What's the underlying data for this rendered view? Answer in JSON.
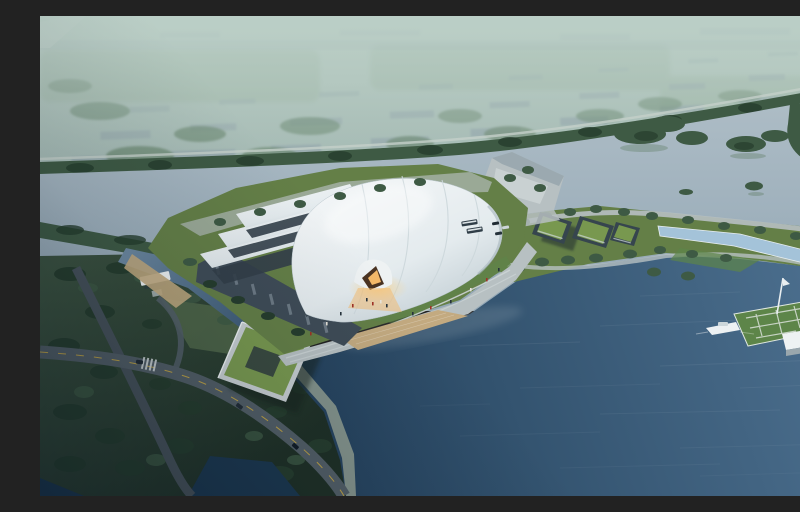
{
  "scene": {
    "kind": "aerial-architectural-rendering",
    "subject": "lakeside exhibition hall with layered white shell roof",
    "time_of_day": "hazy dusk",
    "elements": [
      "hazy distant cityscape with low gray blocks and tree masses",
      "tree-lined shore road separating city from lake",
      "pale upper lake with wooded islands",
      "white curved-shell exhibition hall with dark striped base",
      "amber-lit entrance arch with visitors",
      "waterfront promenade with steps and timber deck",
      "angular jetty plaza",
      "green-roof office buildings with parking, buses and cars",
      "linear reflecting pool in waterfront park strip",
      "lawn pier with mast, white pavilion and motor boat",
      "L-shaped green-roof courtyard building",
      "road bridge over dark channel",
      "deep blue bay in the foreground"
    ]
  },
  "palette": {
    "haze_top": "#b4c7bd",
    "haze_mid": "#9cb1ad",
    "city_block": "#8b9da6",
    "field": "#8fa892",
    "tree_far": "#5c7a5f",
    "tree_mid": "#3e5a44",
    "tree_dark": "#263d2d",
    "shore_road": "#c4cfc9",
    "lake_far": "#a6b6c1",
    "channel_hi": "#6c88a0",
    "bay_light": "#46698a",
    "bay_dark": "#1c3850",
    "shell_light": "#f4f7f8",
    "shell_shade": "#c7d2d8",
    "shell_gap": "#333f49",
    "base_facade": "#3f4c57",
    "base_window": "#93a1ab",
    "lawn": "#647f47",
    "lawn_bright": "#5d8549",
    "plaza": "#b7c0c2",
    "plaza_light": "#ccd4d5",
    "deck": "#c3aa80",
    "glow": "#f5b969",
    "arch_dark": "#4a3322",
    "road": "#525e66",
    "road_dark": "#47525a",
    "road_line": "#d7b23f",
    "pool": "#a4c3d9",
    "green_roof": "#78984f",
    "bldg_dark": "#36454e",
    "white": "#eef2f3",
    "beach": "#c0a87e",
    "people_red": "#a03226",
    "people_dark": "#27333c"
  }
}
